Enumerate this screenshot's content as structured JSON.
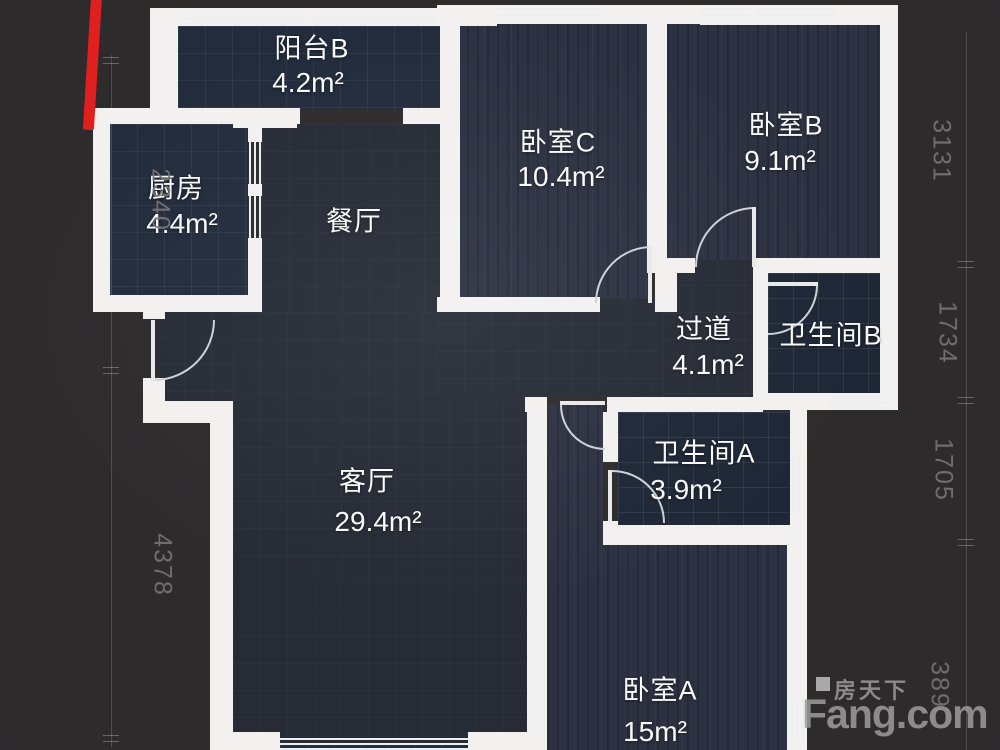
{
  "plan": {
    "type": "floorplan",
    "rooms": [
      {
        "id": "balcony-b",
        "name": "阳台B",
        "area": "4.2m²"
      },
      {
        "id": "kitchen",
        "name": "厨房",
        "area": "4.4m²"
      },
      {
        "id": "dining",
        "name": "餐厅",
        "area": ""
      },
      {
        "id": "bedroom-c",
        "name": "卧室C",
        "area": "10.4m²"
      },
      {
        "id": "bedroom-b",
        "name": "卧室B",
        "area": "9.1m²"
      },
      {
        "id": "hallway",
        "name": "过道",
        "area": "4.1m²"
      },
      {
        "id": "bathroom-b",
        "name": "卫生间B",
        "area": ""
      },
      {
        "id": "bathroom-a",
        "name": "卫生间A",
        "area": "3.9m²"
      },
      {
        "id": "living",
        "name": "客厅",
        "area": "29.4m²"
      },
      {
        "id": "bedroom-a",
        "name": "卧室A",
        "area": "15m²"
      }
    ],
    "dimensions": {
      "left": [
        "2340",
        "4378"
      ],
      "right": [
        "3131",
        "1734",
        "1705",
        "389"
      ]
    }
  },
  "watermark": {
    "brand_cn": "房天下",
    "brand_en": "Fang.com"
  },
  "colors": {
    "background": "#2d2b2c",
    "wall": "#f2f1ef",
    "floor_plain": "#262b36",
    "floor_tile": "#222c3c",
    "floor_wood": "#2d3242",
    "door_arc": "#cdd2d8",
    "dimension_text": "#767676",
    "watermark_gray": "#9c9c9c",
    "red_marker": "#e01f1f"
  }
}
